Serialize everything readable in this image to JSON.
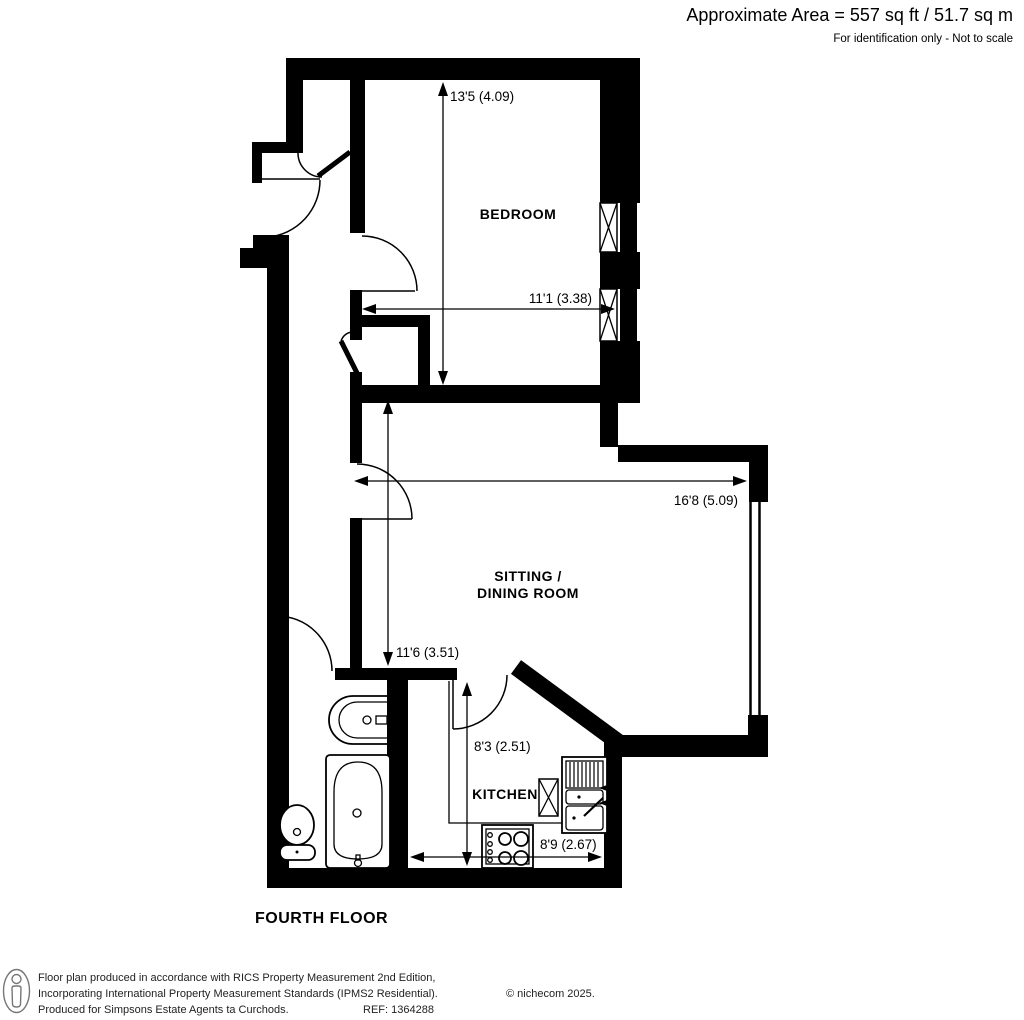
{
  "header": {
    "area_title": "Approximate Area = 557 sq ft / 51.7 sq m",
    "disclaimer": "For identification only - Not to scale"
  },
  "floor_label": "FOURTH FLOOR",
  "rooms": {
    "bedroom": {
      "label": "BEDROOM",
      "depth": "13'5 (4.09)",
      "width": "11'1 (3.38)"
    },
    "sitting_dining": {
      "label_line1": "SITTING /",
      "label_line2": "DINING ROOM",
      "width": "16'8 (5.09)",
      "depth": "11'6 (3.51)"
    },
    "kitchen": {
      "label": "KITCHEN",
      "depth": "8'3 (2.51)",
      "width": "8'9 (2.67)"
    }
  },
  "colors": {
    "ink": "#000000",
    "paper": "#ffffff"
  },
  "footer": {
    "line1": "Floor plan produced in accordance with RICS Property Measurement 2nd Edition,",
    "line2": "Incorporating International Property Measurement Standards (IPMS2 Residential).",
    "copyright": "© nichecom 2025.",
    "line3": "Produced for Simpsons Estate Agents ta Curchods.",
    "ref": "REF: 1364288"
  }
}
